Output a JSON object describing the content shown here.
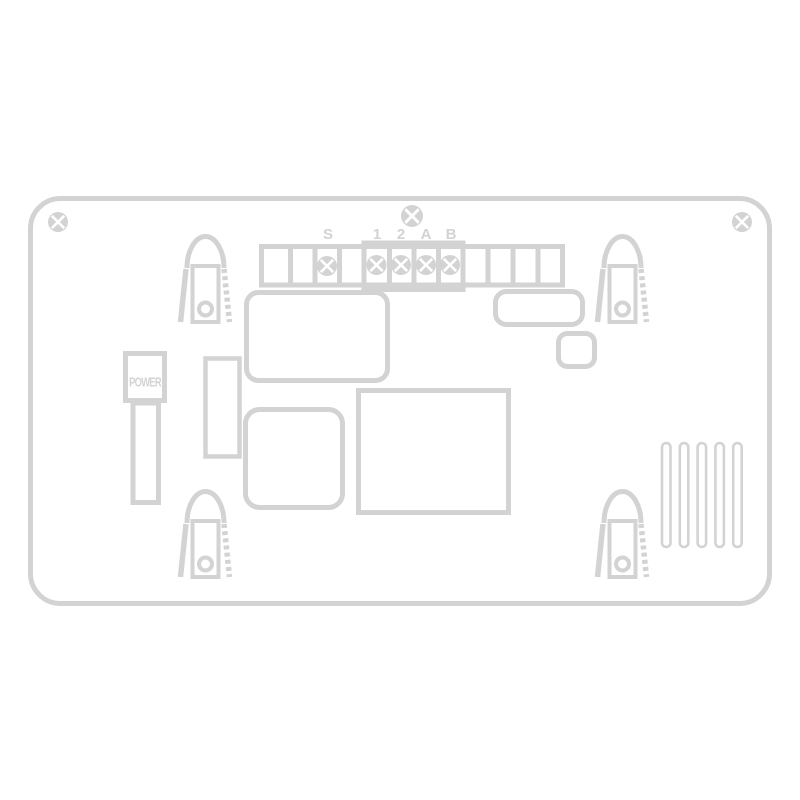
{
  "meta": {
    "description": "Rear-panel technical line diagram of a device backplate",
    "colors": {
      "line": "#d3d3d3",
      "background": "#ffffff",
      "notch": "#ffffff"
    }
  },
  "terminal": {
    "labels": {
      "s": "S",
      "one": "1",
      "two": "2",
      "a": "A",
      "b": "B"
    },
    "cell_count": 12,
    "screw_cells": [
      "S",
      "1",
      "2",
      "A",
      "B"
    ]
  },
  "power": {
    "label": "POWER"
  },
  "fins": {
    "count": 5
  },
  "clips": {
    "count": 4
  },
  "screws": {
    "corner_count": 2,
    "top_center_count": 1
  }
}
